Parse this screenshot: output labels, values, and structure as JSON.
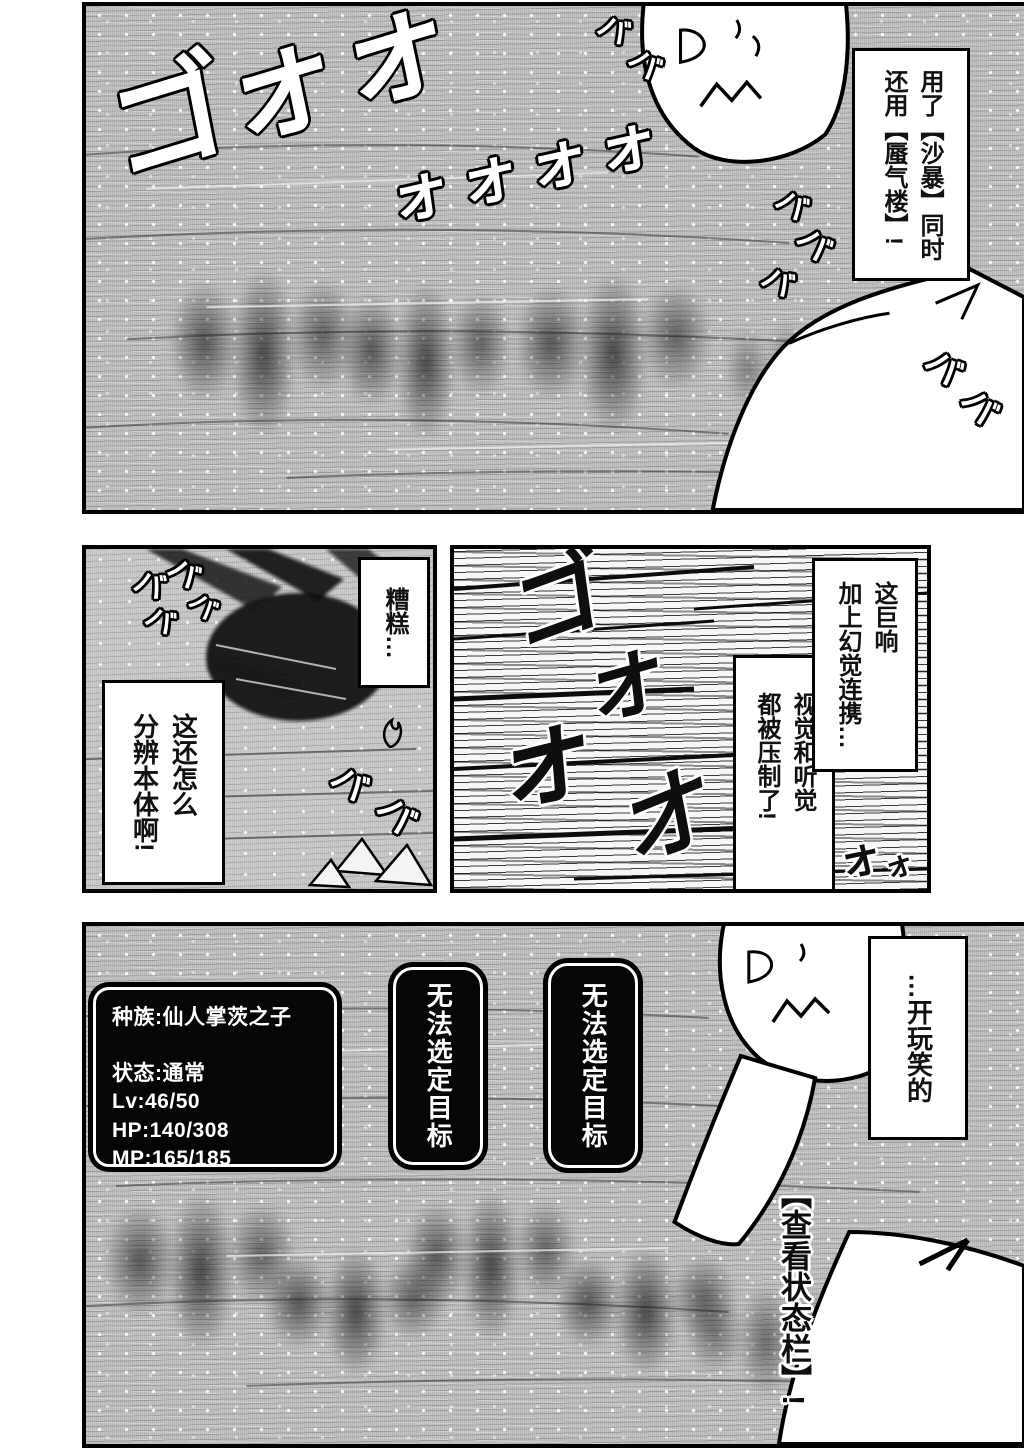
{
  "sfx": {
    "storm_main": "ゴォォ",
    "storm_tail": "ォォォォ",
    "ba": "バ",
    "roar_1": "ゴ",
    "roar_2": "ォ",
    "roar_3": "ォ",
    "roar_4": "オ",
    "roar_small": "ォ",
    "view_status": "【查看状态栏】!"
  },
  "panel_top": {
    "speech_skills": {
      "line1": "用了【沙暴】同时",
      "line2": "还用【蜃气楼】!"
    }
  },
  "panel_mid_left": {
    "speech_trouble": "糟糕…",
    "speech_identify": {
      "line1": "这还怎么",
      "line2": "分辨本体啊!"
    }
  },
  "panel_mid_right": {
    "speech_noise": {
      "line1": "这巨响",
      "line2": "加上幻觉连携…"
    },
    "speech_senses": {
      "line1": "视觉和听觉",
      "line2": "都被压制了!"
    }
  },
  "panel_bottom": {
    "status_window": {
      "lines": [
        "种族:仙人掌茨之子",
        "",
        "状态:通常",
        "Lv:46/50",
        "HP:140/308",
        "MP:165/185"
      ]
    },
    "target_error": "无法选定目标",
    "speech_joke": "…开玩笑的"
  }
}
